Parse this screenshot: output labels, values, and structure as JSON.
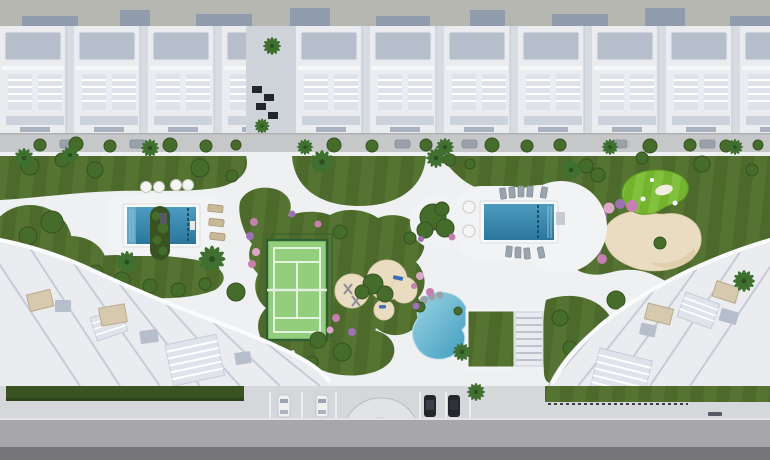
{
  "meta": {
    "width": 770,
    "height": 460
  },
  "scene": {
    "title": "Aerial top-down 3D architectural rendering of a residential resort: apartment rows, landscaped gardens, two lap pools, lagoon pool, padel court, putting green with sand bunker, street with parked cars",
    "areas": {
      "top": "apartment-row-with-cast-shadows",
      "middle": "garden-amenity-deck",
      "bottom_left": "apartment-building",
      "bottom_right": "apartment-building",
      "bottom": "street-with-parking"
    },
    "amenities": [
      "lap-pool-left",
      "lap-pool-right",
      "lagoon-pool",
      "padel-court",
      "putting-green",
      "sand-bunker",
      "play-area",
      "sun-loungers",
      "parasols"
    ],
    "counts": {
      "lap_pools": 2,
      "lagoon_pools": 1,
      "padel_courts": 1,
      "putting_greens": 1,
      "parked_cars_front": 4
    },
    "cars_front": [
      "white",
      "white",
      "dark",
      "dark"
    ]
  },
  "colors": {
    "sky_band": "#b6b7b1",
    "shadow": "#8d99ac",
    "bldg_white": "#eaecef",
    "roof_panel": "#b7becb",
    "roof_shade": "#d7dbe2",
    "roof_line": "#c3c9d4",
    "ladder": "#dfe3e9",
    "street": "#c6c7c9",
    "path": "#eef0f2",
    "deck": "#f2f3f5",
    "lawn": "#4d6a2c",
    "lawn_light": "#5d7c36",
    "lawn_dark": "#3c5722",
    "hedge": "#3a5323",
    "pool": "#3583aa",
    "pool_light": "#6fb1cd",
    "pool_dark": "#1f4f66",
    "lagoon": "#7fc4d8",
    "lagoon_deep": "#3e9abf",
    "court": "#93ce7d",
    "court_fence": "#2e5f30",
    "court_line": "#ffffff",
    "green": "#74b32e",
    "green_light": "#8cc94a",
    "sand": "#e9dcc0",
    "sand_dark": "#d9c49d",
    "flower_pink": "#c67fae",
    "flower_purple": "#9d72b4",
    "flower_light": "#dca8c8",
    "tree": "#466c2c",
    "tree_dark": "#35521f",
    "palm": "#3f7030",
    "tan": "#c9b896",
    "lounger_gray": "#9aa4ae",
    "promenade": "#d6d7da",
    "road": "#a7a7ab",
    "road_dark": "#75757a",
    "curb": "#e3e4e6",
    "car_white": "#eef0f2",
    "car_dark": "#23262b",
    "metal": "#565b63"
  }
}
